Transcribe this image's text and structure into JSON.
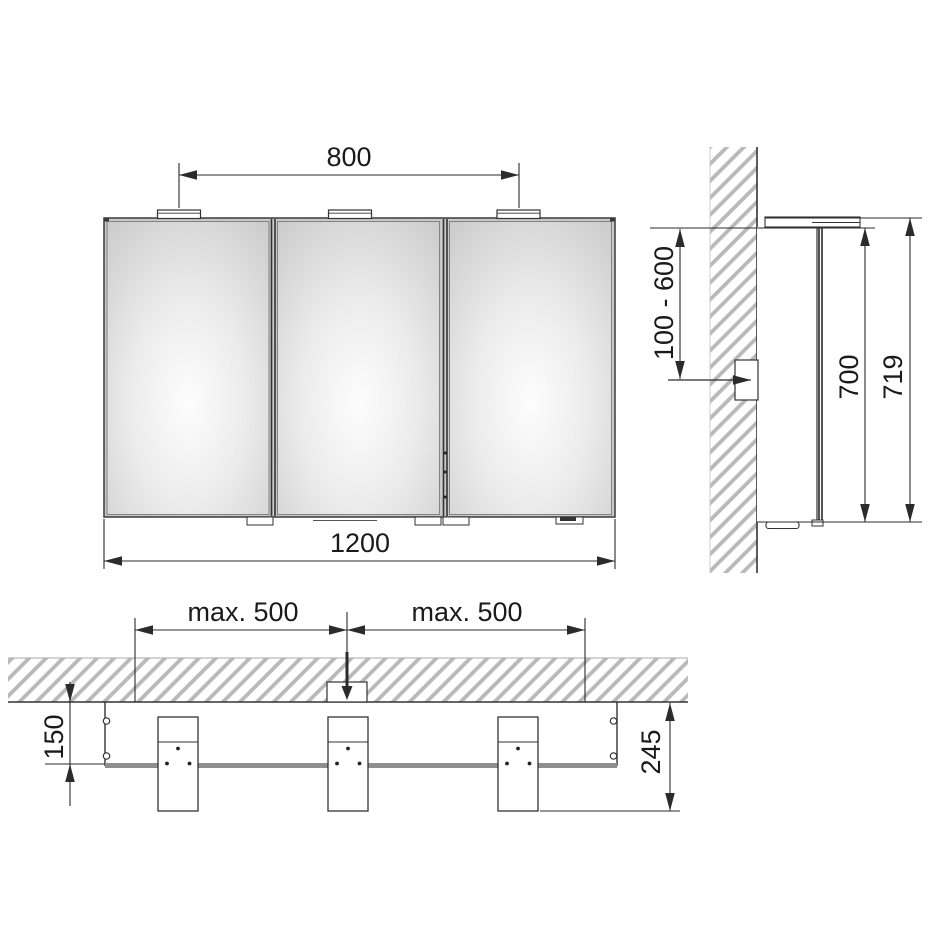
{
  "drawing": {
    "title": "mirror-cabinet-installation-drawing",
    "front_view": {
      "label_light_spacing": "800",
      "label_cabinet_width": "1200"
    },
    "side_view": {
      "label_mounting_height_range": "100 - 600",
      "label_cabinet_height": "700",
      "label_total_height": "719"
    },
    "top_view": {
      "label_max_left": "max. 500",
      "label_max_right": "max. 500",
      "label_wall_to_front": "150",
      "label_wall_to_light_front": "245"
    },
    "colors": {
      "line": "#2b2b2b",
      "hatch": "#b9b9b9",
      "mirror_highlight": "#fdfdfd",
      "mirror_shade": "#cfcfcf",
      "front_edge_gray": "#8f8f8f",
      "background": "#ffffff"
    }
  }
}
